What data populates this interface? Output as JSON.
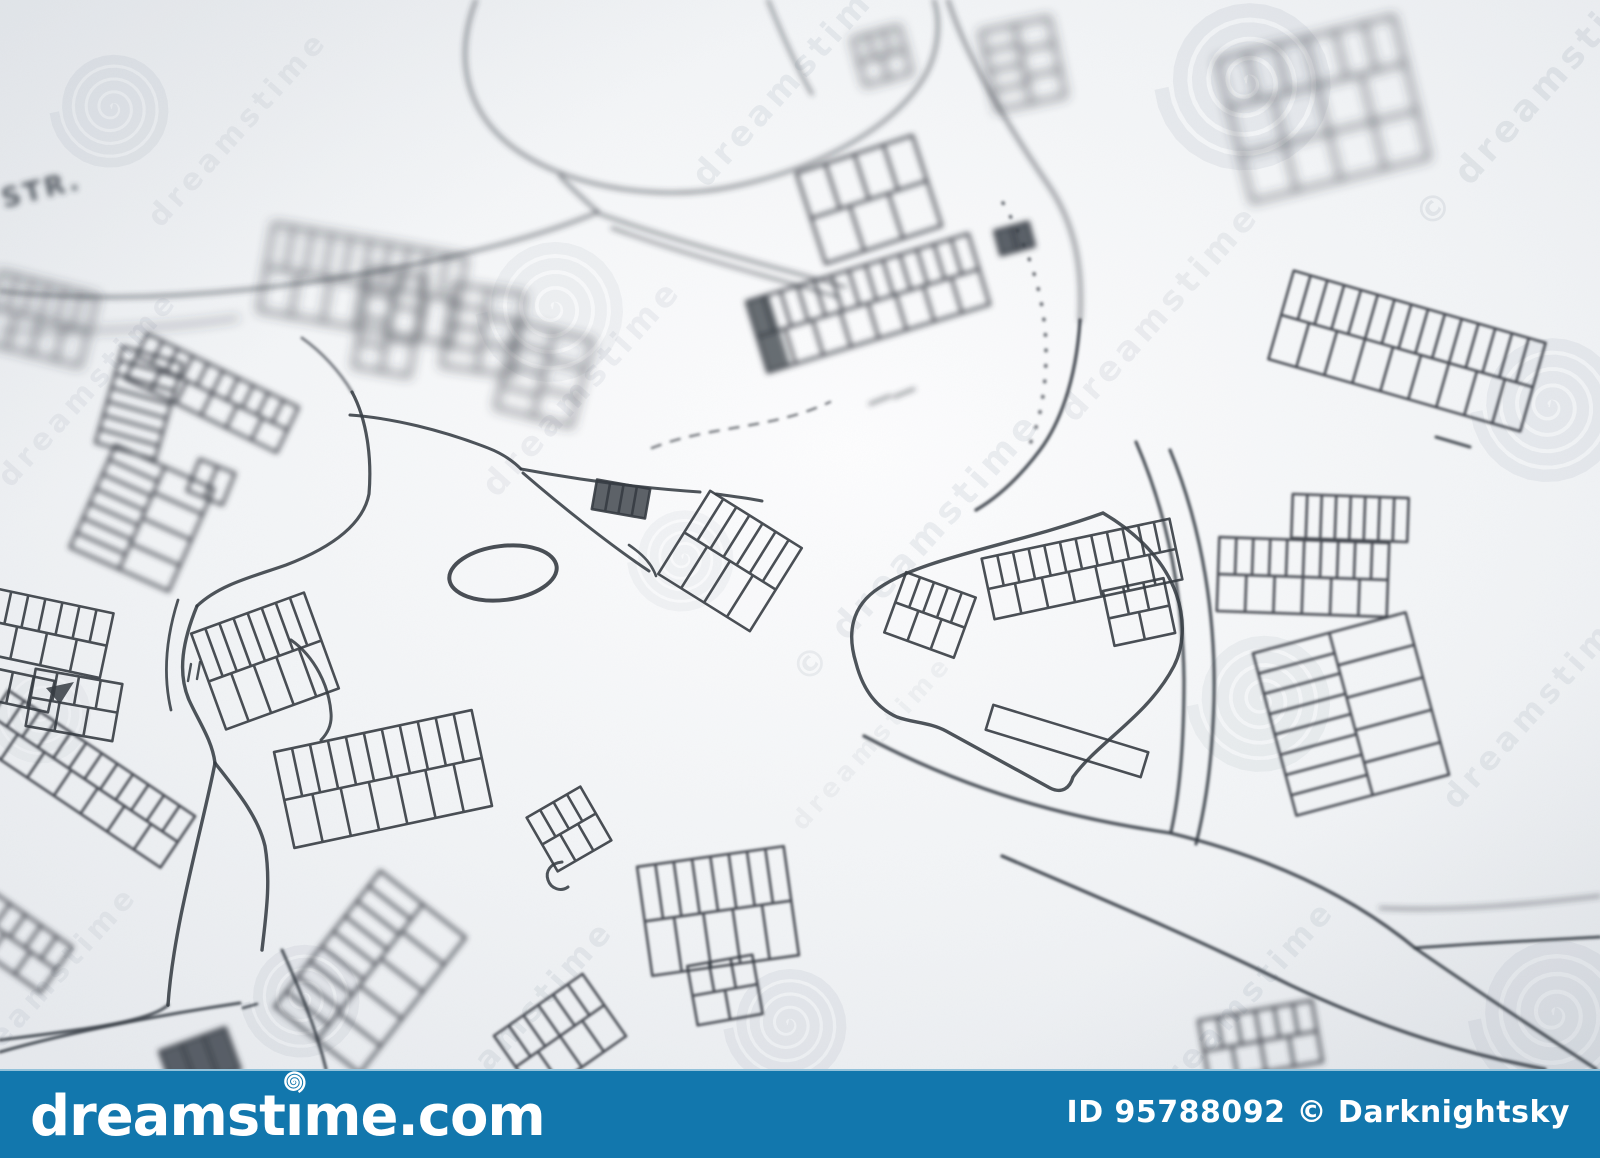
{
  "image": {
    "width": 1600,
    "height": 1158,
    "map_height": 1069
  },
  "paper": {
    "base_color": "#eef0f3",
    "highlight_color": "#fdfdfe",
    "edge_color": "#e6e9ed",
    "ink_color": "#363c43"
  },
  "map": {
    "street_label": {
      "text": "STR.",
      "x": 4,
      "y": 208,
      "rot": -14,
      "size": 27,
      "blur": 2.2
    },
    "ellipse": {
      "cx": 503,
      "cy": 573,
      "rx": 54,
      "ry": 27,
      "rot": -7,
      "w": 4,
      "blur": 0
    },
    "triangle_mark": {
      "d": "M 46,688 L 74,682 L 60,704 Z",
      "blur": 0
    },
    "roads": [
      {
        "name": "loop-road",
        "d": "M 476,0 C 452,62 468,118 521,153 C 576,189 662,201 731,187 C 809,171 889,133 923,79 C 939,53 941,22 934,0",
        "w": 3.2,
        "blur": 2,
        "light": true
      },
      {
        "name": "loop-spur",
        "d": "M 560,176 C 574,191 587,202 598,212",
        "w": 3.2,
        "blur": 2,
        "light": true
      },
      {
        "name": "loop-inner-spur",
        "d": "M 768,0 C 782,35 796,66 812,94",
        "w": 3,
        "blur": 2,
        "light": true
      },
      {
        "name": "west-road-1",
        "d": "M 598,212 C 505,252 330,286 180,295 C 115,299 50,297 0,291",
        "w": 3.2,
        "blur": 2,
        "light": true
      },
      {
        "name": "west-road-2",
        "d": "M 238,318 C 170,328 80,334 0,330",
        "w": 2.8,
        "blur": 3,
        "light": true
      },
      {
        "name": "junction-east-1",
        "d": "M 600,214 C 690,246 775,267 845,287",
        "w": 3,
        "blur": 2,
        "light": true
      },
      {
        "name": "junction-east-2",
        "d": "M 612,228 C 695,258 770,277 838,297",
        "w": 2.8,
        "blur": 2,
        "light": true
      },
      {
        "name": "north-road-upper",
        "d": "M 948,0 C 968,62 1012,132 1049,186 C 1076,226 1083,270 1080,320",
        "w": 3.4,
        "blur": 2,
        "light": true
      },
      {
        "name": "north-road-lower",
        "d": "M 1080,320 C 1076,384 1058,426 1040,450 C 1022,474 1000,496 976,510",
        "w": 3.4,
        "blur": 1
      },
      {
        "name": "inner-dotted-arc",
        "d": "M 1003,203 C 1030,250 1046,300 1046,352 C 1046,390 1040,420 1030,444",
        "w": 4,
        "blur": 1,
        "light": true,
        "dash": "0.5 15",
        "cap": "round"
      },
      {
        "name": "parcel-outline",
        "d": "M 1103,513 C 1015,545 922,558 879,588 C 851,606 847,634 856,663 C 863,690 877,708 897,717 C 913,723 929,722 946,731 L 1050,788 C 1062,794 1070,788 1073,777 C 1098,742 1148,716 1174,666 C 1192,630 1186,562 1103,513",
        "w": 3.4,
        "blur": 0
      },
      {
        "name": "east-road-outer-1",
        "d": "M 1136,442 C 1170,520 1183,600 1184,680 C 1184,742 1180,792 1171,832",
        "w": 3.2,
        "blur": 1
      },
      {
        "name": "east-road-outer-2",
        "d": "M 1170,450 C 1204,532 1216,622 1214,702 C 1212,762 1206,804 1196,844",
        "w": 3.2,
        "blur": 1
      },
      {
        "name": "se-road-upper",
        "d": "M 864,736 C 970,792 1068,818 1170,833 C 1260,855 1345,890 1415,948",
        "w": 3.4,
        "blur": 1
      },
      {
        "name": "se-road-branch-flat",
        "d": "M 1415,948 C 1480,943 1545,940 1600,937",
        "w": 3,
        "blur": 1
      },
      {
        "name": "se-road-branch-steep",
        "d": "M 1415,948 C 1478,992 1540,1032 1596,1069",
        "w": 3.2,
        "blur": 1
      },
      {
        "name": "se-road-lower",
        "d": "M 1002,856 C 1100,898 1200,940 1290,985 C 1390,1032 1470,1055 1545,1069",
        "w": 3.4,
        "blur": 1
      },
      {
        "name": "se-branch-faint",
        "d": "M 1380,908 C 1455,912 1540,903 1600,896",
        "w": 2.6,
        "blur": 2,
        "light": true
      },
      {
        "name": "sw-lane",
        "d": "M 282,950 C 300,990 316,1028 326,1069",
        "w": 3,
        "blur": 1
      },
      {
        "name": "sw-corner-road-1",
        "d": "M 168,1005 C 150,1022 80,1030 0,1040",
        "w": 3,
        "blur": 1
      },
      {
        "name": "sw-corner-road-2",
        "d": "M 240,1003 C 160,1015 70,1032 0,1052",
        "w": 3,
        "blur": 1
      },
      {
        "name": "y-stem",
        "d": "M 197,606 C 183,640 177,672 189,700 C 199,722 212,740 215,763",
        "w": 3.4,
        "blur": 0
      },
      {
        "name": "y-left",
        "d": "M 215,763 C 208,800 194,852 181,915 C 175,945 170,975 168,1005",
        "w": 3.4,
        "blur": 0
      },
      {
        "name": "y-right",
        "d": "M 215,763 C 236,790 258,816 265,846 C 271,882 266,915 262,950",
        "w": 3.4,
        "blur": 0
      },
      {
        "name": "y-edge",
        "d": "M 178,600 C 166,638 163,676 171,710",
        "w": 2.8,
        "blur": 0
      },
      {
        "name": "y-ticks",
        "d": "M 191,664 l -3,17 M 200,662 l -3,17",
        "w": 2.4,
        "blur": 0
      },
      {
        "name": "center-road",
        "d": "M 352,392 C 367,420 372,458 369,494 C 362,530 320,552 286,565 C 255,576 220,584 197,606",
        "w": 3.2,
        "blur": 0
      },
      {
        "name": "center-road-up",
        "d": "M 352,392 C 340,372 322,352 302,338",
        "w": 3,
        "blur": 1,
        "light": true
      },
      {
        "name": "center-arc",
        "d": "M 291,640 C 315,657 329,686 331,713 C 332,724 328,733 321,740",
        "w": 3,
        "blur": 0
      },
      {
        "name": "apex-road",
        "d": "M 350,415 C 392,418 442,430 488,448 C 501,453 513,461 521,469",
        "w": 3,
        "blur": 0
      },
      {
        "name": "wedge-top-1",
        "d": "M 521,469 C 580,480 640,488 700,492",
        "w": 3,
        "blur": 0
      },
      {
        "name": "wedge-top-2",
        "d": "M 716,494 C 731,496 748,498 762,501",
        "w": 3,
        "blur": 0
      },
      {
        "name": "wedge-bottom",
        "d": "M 523,473 C 560,505 610,545 649,571",
        "w": 3,
        "blur": 0
      },
      {
        "name": "wedge-bracket",
        "d": "M 629,545 C 645,556 652,565 656,576",
        "w": 2.6,
        "blur": 0
      },
      {
        "name": "dashed-boundary",
        "d": "M 652,448 C 710,425 770,430 830,402",
        "w": 2.6,
        "blur": 1,
        "light": true,
        "dash": "9 11"
      },
      {
        "name": "tick-marks",
        "d": "M 870,404 l 20,-8 M 894,397 l 20,-8",
        "w": 3,
        "blur": 2,
        "light": true
      },
      {
        "name": "building-dash",
        "d": "M 1436,437 l 34,10",
        "w": 3,
        "blur": 1
      },
      {
        "name": "corner-dash",
        "d": "M 243,1008 l 14,-4",
        "w": 2.6,
        "blur": 1
      },
      {
        "name": "c-mark",
        "d": "M 562,862 C 551,863 545,871 548,880 C 551,889 561,892 568,887",
        "w": 3,
        "blur": 0
      }
    ],
    "buildings": [
      {
        "x": -10,
        "y": 283,
        "w": 100,
        "h": 72,
        "rot": 14,
        "rungs": 6,
        "rows": 2,
        "blur": 3
      },
      {
        "x": 108,
        "y": 353,
        "w": 62,
        "h": 100,
        "rot": 16,
        "rungs": 7,
        "rows": 1,
        "blur": 2
      },
      {
        "x": 128,
        "y": 368,
        "w": 168,
        "h": 50,
        "rot": 26,
        "rungs": 10,
        "rows": 2,
        "blur": 2
      },
      {
        "x": 88,
        "y": 462,
        "w": 108,
        "h": 112,
        "rot": 24,
        "rungs": 7,
        "rows": 2,
        "blur": 2
      },
      {
        "x": 192,
        "y": 465,
        "w": 38,
        "h": 34,
        "rot": 22,
        "rungs": 2,
        "rows": 1,
        "blur": 2
      },
      {
        "x": 265,
        "y": 240,
        "w": 195,
        "h": 88,
        "rot": 10,
        "rungs": 10,
        "rows": 2,
        "blur": 3
      },
      {
        "x": 362,
        "y": 272,
        "w": 56,
        "h": 100,
        "rot": 10,
        "rungs": 4,
        "rows": 2,
        "blur": 3
      },
      {
        "x": 447,
        "y": 289,
        "w": 72,
        "h": 82,
        "rot": 8,
        "rungs": 4,
        "rows": 2,
        "blur": 3
      },
      {
        "x": 505,
        "y": 330,
        "w": 78,
        "h": 88,
        "rot": 14,
        "rungs": 4,
        "rows": 2,
        "blur": 3
      },
      {
        "x": 808,
        "y": 152,
        "w": 122,
        "h": 95,
        "rot": -18,
        "rungs": 4,
        "rows": 2,
        "blur": 2
      },
      {
        "x": 752,
        "y": 266,
        "w": 232,
        "h": 74,
        "rot": -17,
        "rungs": 13,
        "rows": 2,
        "blur": 2,
        "darkStart": true
      },
      {
        "x": 997,
        "y": 226,
        "w": 35,
        "h": 25,
        "rot": -15,
        "rungs": 2,
        "rows": 1,
        "blur": 2,
        "fill": true
      },
      {
        "x": 858,
        "y": 32,
        "w": 48,
        "h": 48,
        "rot": -15,
        "rungs": 3,
        "rows": 2,
        "blur": 3
      },
      {
        "x": 988,
        "y": 24,
        "w": 70,
        "h": 80,
        "rot": -12,
        "rungs": 4,
        "rows": 2,
        "blur": 3
      },
      {
        "x": 1232,
        "y": 36,
        "w": 182,
        "h": 146,
        "rot": -14,
        "rungs": 6,
        "rows": 3,
        "blur": 3
      },
      {
        "x": 1276,
        "y": 305,
        "w": 262,
        "h": 92,
        "rot": 16,
        "rungs": 15,
        "rows": 2,
        "blur": 1
      },
      {
        "x": 1292,
        "y": 496,
        "w": 116,
        "h": 44,
        "rot": 2,
        "rungs": 8,
        "rows": 1,
        "blur": 1
      },
      {
        "x": 1218,
        "y": 540,
        "w": 170,
        "h": 74,
        "rot": 2,
        "rungs": 10,
        "rows": 2,
        "blur": 1
      },
      {
        "x": 1272,
        "y": 630,
        "w": 158,
        "h": 168,
        "rot": -15,
        "rungs": 8,
        "rows": 2,
        "blur": 1
      },
      {
        "x": 893,
        "y": 583,
        "w": 74,
        "h": 64,
        "rot": 20,
        "rungs": 5,
        "rows": 2,
        "blur": 0
      },
      {
        "x": 986,
        "y": 538,
        "w": 192,
        "h": 62,
        "rot": -12,
        "rungs": 12,
        "rows": 2,
        "blur": 0
      },
      {
        "x": 1108,
        "y": 584,
        "w": 62,
        "h": 56,
        "rot": -12,
        "rungs": 3,
        "rows": 2,
        "blur": 0
      },
      {
        "x": 986,
        "y": 728,
        "w": 162,
        "h": 26,
        "rot": 17,
        "rungs": 1,
        "rows": 1,
        "blur": 0
      },
      {
        "x": 205,
        "y": 610,
        "w": 120,
        "h": 102,
        "rot": -20,
        "rungs": 8,
        "rows": 2,
        "blur": 0
      },
      {
        "x": 282,
        "y": 730,
        "w": 202,
        "h": 98,
        "rot": -12,
        "rungs": 11,
        "rows": 2,
        "blur": 0
      },
      {
        "x": 538,
        "y": 798,
        "w": 62,
        "h": 62,
        "rot": -30,
        "rungs": 4,
        "rows": 2,
        "blur": 0
      },
      {
        "x": 506,
        "y": 998,
        "w": 108,
        "h": 76,
        "rot": -35,
        "rungs": 6,
        "rows": 2,
        "blur": 1
      },
      {
        "x": 316,
        "y": 886,
        "w": 108,
        "h": 172,
        "rot": 38,
        "rungs": 9,
        "rows": 2,
        "blur": 2
      },
      {
        "x": -28,
        "y": 748,
        "w": 225,
        "h": 62,
        "rot": 34,
        "rungs": 12,
        "rows": 2,
        "blur": 1
      },
      {
        "x": -14,
        "y": 600,
        "w": 122,
        "h": 66,
        "rot": 12,
        "rungs": 7,
        "rows": 2,
        "blur": 0
      },
      {
        "x": -12,
        "y": 674,
        "w": 64,
        "h": 32,
        "rot": 12,
        "rungs": 3,
        "rows": 1,
        "blur": 0
      },
      {
        "x": 30,
        "y": 676,
        "w": 88,
        "h": 58,
        "rot": 10,
        "rungs": 4,
        "rows": 2,
        "blur": 0
      },
      {
        "x": 1203,
        "y": 1010,
        "w": 115,
        "h": 62,
        "rot": -10,
        "rungs": 6,
        "rows": 2,
        "blur": 2
      },
      {
        "x": -30,
        "y": 915,
        "w": 95,
        "h": 55,
        "rot": 35,
        "rungs": 5,
        "rows": 2,
        "blur": 2
      },
      {
        "x": 165,
        "y": 1038,
        "w": 70,
        "h": 45,
        "rot": -20,
        "rungs": 3,
        "rows": 1,
        "blur": 2,
        "fill": true
      },
      {
        "x": 594,
        "y": 484,
        "w": 54,
        "h": 30,
        "rot": 10,
        "rungs": 4,
        "rows": 1,
        "blur": 0,
        "fill": true
      },
      {
        "x": 676,
        "y": 512,
        "w": 108,
        "h": 98,
        "rot": 32,
        "rungs": 7,
        "rows": 2,
        "blur": 0
      },
      {
        "x": 644,
        "y": 856,
        "w": 148,
        "h": 110,
        "rot": -8,
        "rungs": 8,
        "rows": 2,
        "blur": 1
      },
      {
        "x": 692,
        "y": 960,
        "w": 66,
        "h": 60,
        "rot": -10,
        "rungs": 3,
        "rows": 2,
        "blur": 1
      }
    ]
  },
  "watermarks": {
    "text": "dreamstime",
    "copyright_symbol": "©",
    "color": "#7e8c99",
    "rotation": -48,
    "texts": [
      {
        "x": 245,
        "y": 135,
        "s": 30,
        "o": 0.1
      },
      {
        "x": 800,
        "y": 85,
        "s": 34,
        "o": 0.12
      },
      {
        "x": 1548,
        "y": 100,
        "s": 36,
        "o": 0.14,
        "c": true
      },
      {
        "x": 1168,
        "y": 320,
        "s": 34,
        "o": 0.11
      },
      {
        "x": 95,
        "y": 395,
        "s": 30,
        "o": 0.1
      },
      {
        "x": 590,
        "y": 395,
        "s": 34,
        "o": 0.1
      },
      {
        "x": 925,
        "y": 555,
        "s": 36,
        "o": 0.12,
        "c": true
      },
      {
        "x": 1545,
        "y": 712,
        "s": 32,
        "o": 0.12
      },
      {
        "x": 878,
        "y": 748,
        "s": 26,
        "o": 0.08
      },
      {
        "x": 527,
        "y": 1030,
        "s": 32,
        "o": 0.12
      },
      {
        "x": 1248,
        "y": 1010,
        "s": 32,
        "o": 0.12
      },
      {
        "x": 55,
        "y": 990,
        "s": 30,
        "o": 0.1
      }
    ],
    "spirals": [
      {
        "x": 112,
        "y": 108,
        "r": 58,
        "o": 0.1
      },
      {
        "x": 553,
        "y": 308,
        "r": 72,
        "o": 0.08
      },
      {
        "x": 1247,
        "y": 82,
        "r": 86,
        "o": 0.11
      },
      {
        "x": 683,
        "y": 558,
        "r": 52,
        "o": 0.07
      },
      {
        "x": 303,
        "y": 998,
        "r": 58,
        "o": 0.1
      },
      {
        "x": 788,
        "y": 1024,
        "r": 60,
        "o": 0.1
      },
      {
        "x": 1262,
        "y": 700,
        "r": 70,
        "o": 0.09
      },
      {
        "x": 1550,
        "y": 406,
        "r": 74,
        "o": 0.1
      },
      {
        "x": 1554,
        "y": 1014,
        "r": 80,
        "o": 0.1
      },
      {
        "x": 42,
        "y": 712,
        "r": 50,
        "o": 0.06
      }
    ]
  },
  "footer": {
    "bg_color": "#1277ad",
    "logo": "dreamstime.com",
    "credit": "ID 95788092 © Darknightsky"
  }
}
